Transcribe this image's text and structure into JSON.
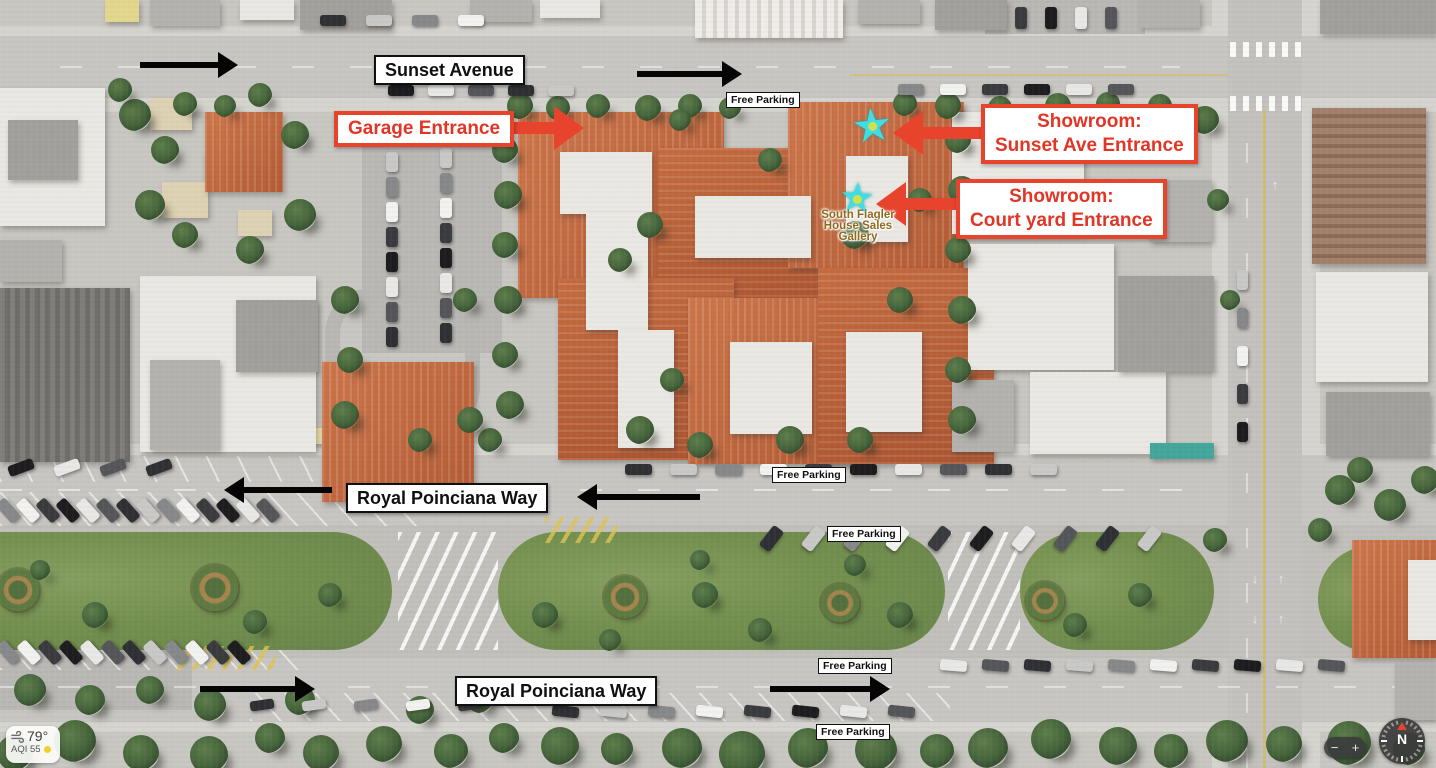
{
  "labels": {
    "sunset_avenue": "Sunset Avenue",
    "royal_poinciana_way": "Royal Poinciana Way",
    "free_parking": "Free Parking"
  },
  "callouts": {
    "garage_entrance": "Garage Entrance",
    "showroom_sunset": [
      "Showroom:",
      "Sunset Ave Entrance"
    ],
    "showroom_courtyard": [
      "Showroom:",
      "Court yard Entrance"
    ]
  },
  "poi_label": [
    "South Flagler",
    "House Sales",
    "Gallery"
  ],
  "weather_widget": {
    "temperature": "79°",
    "air_quality": "AQI 55"
  },
  "map_controls": {
    "zoom_out": "−",
    "zoom_in": "+",
    "compass_north": "N"
  },
  "colors": {
    "callout_red": "#e8432c",
    "annotation_black": "#050505",
    "star_cyan": "#3fdde6",
    "star_center_yellow": "#cfe24e",
    "poi_text_olive": "#8f6a1d",
    "aqi_dot_yellow": "#f2cf2e"
  }
}
